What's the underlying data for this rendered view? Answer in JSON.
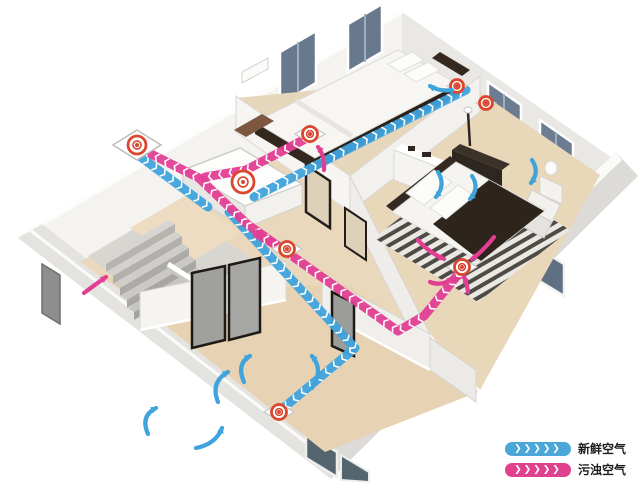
{
  "title": "home-fresh-air-ventilation-system-diagram",
  "legend": {
    "chevrons": "❯❯❯❯❯",
    "items": [
      {
        "id": "fresh",
        "label": "新鲜空气",
        "color": "#4aa7d8"
      },
      {
        "id": "exhaust",
        "label": "污浊空气",
        "color": "#e0418f"
      }
    ]
  },
  "colors": {
    "fresh_air": "#3fa3dc",
    "polluted_air": "#e23e94",
    "vent_ring": "#d9472f",
    "floor_tan": "#ead8bd",
    "wall_white": "#f4f3f0"
  },
  "diagram": {
    "type": "ventilation-floorplan",
    "ducts": [
      {
        "id": "outdoor-intake",
        "system": "fresh",
        "points": [
          [
            134,
            152
          ],
          [
            208,
            207
          ]
        ]
      },
      {
        "id": "supply-to-bedrooms",
        "system": "fresh",
        "points": [
          [
            254,
            197
          ],
          [
            352,
            147
          ],
          [
            466,
            90
          ]
        ]
      },
      {
        "id": "supply-to-living-room",
        "system": "fresh",
        "points": [
          [
            229,
            212
          ],
          [
            355,
            348
          ],
          [
            281,
            410
          ]
        ]
      },
      {
        "id": "exhaust-from-bedroom2",
        "system": "exhaust",
        "points": [
          [
            309,
            137
          ],
          [
            246,
            170
          ],
          [
            205,
            177
          ]
        ]
      },
      {
        "id": "exhaust-from-master",
        "system": "exhaust",
        "points": [
          [
            461,
            271
          ],
          [
            424,
            316
          ],
          [
            398,
            331
          ],
          [
            247,
            224
          ],
          [
            199,
            178
          ],
          [
            139,
            148
          ]
        ]
      },
      {
        "id": "exhaust-hallway-spur",
        "system": "exhaust",
        "points": [
          [
            288,
            252
          ],
          [
            257,
            234
          ]
        ]
      }
    ],
    "vents": [
      {
        "id": "outdoor-wall-vent",
        "kind": "wall",
        "x": 137,
        "y": 145
      },
      {
        "id": "unit-top-fan",
        "kind": "ring",
        "x": 243,
        "y": 182
      },
      {
        "id": "bedroom2-exhaust-vent",
        "kind": "floor",
        "x": 310,
        "y": 134
      },
      {
        "id": "hallway-exhaust-vent",
        "kind": "floor",
        "x": 287,
        "y": 249
      },
      {
        "id": "master-exhaust-vent",
        "kind": "floor",
        "x": 462,
        "y": 267
      },
      {
        "id": "living-supply-vent",
        "kind": "floor",
        "x": 279,
        "y": 412
      },
      {
        "id": "bedroom2-supply-vent",
        "kind": "small",
        "x": 457,
        "y": 86
      },
      {
        "id": "master-supply-vent",
        "kind": "small",
        "x": 486,
        "y": 103
      }
    ],
    "flow_arrows": [
      {
        "system": "fresh",
        "d": "M218,402 Q210,382 228,372"
      },
      {
        "system": "fresh",
        "d": "M148,434 Q140,416 156,408"
      },
      {
        "system": "fresh",
        "d": "M196,448 Q216,444 222,428"
      },
      {
        "system": "fresh",
        "d": "M312,388 Q324,370 312,356"
      },
      {
        "system": "fresh",
        "d": "M244,382 Q236,364 250,356"
      },
      {
        "system": "fresh",
        "d": "M438,172 Q446,185 436,197"
      },
      {
        "system": "fresh",
        "d": "M472,176 Q480,188 470,199"
      },
      {
        "system": "fresh",
        "d": "M532,160 Q540,172 531,183"
      },
      {
        "system": "fresh",
        "d": "M452,90 Q440,92 430,86"
      },
      {
        "system": "exhaust",
        "d": "M84,293 Q96,284 106,277"
      },
      {
        "system": "exhaust",
        "d": "M324,170 Q325,156 318,147"
      },
      {
        "system": "exhaust",
        "d": "M418,240 Q428,252 444,259"
      },
      {
        "system": "exhaust",
        "d": "M494,237 Q484,250 472,259"
      },
      {
        "system": "exhaust",
        "d": "M430,282 Q442,287 452,278"
      },
      {
        "system": "exhaust",
        "d": "M468,292 Q467,284 464,277"
      }
    ]
  }
}
